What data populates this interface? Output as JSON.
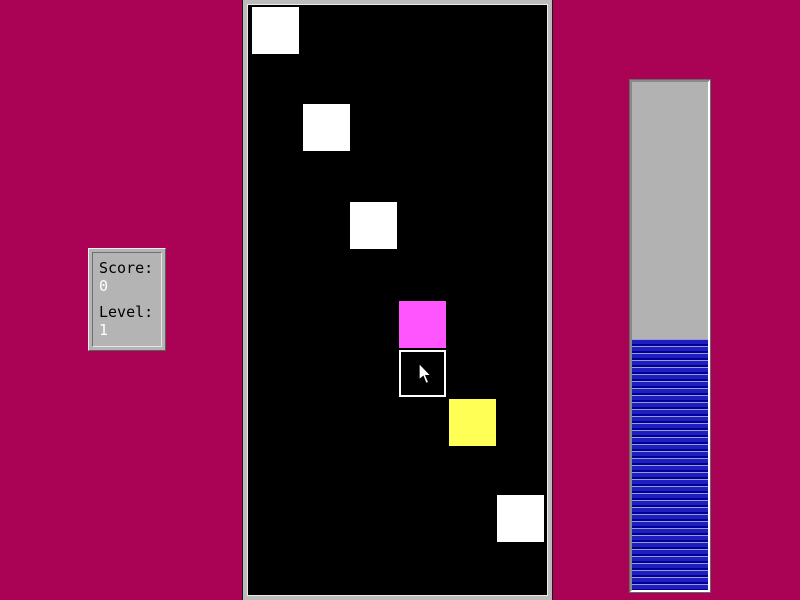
{
  "window": {
    "background_color": "#aa0355"
  },
  "score_panel": {
    "score_label": "Score:",
    "score_value": "0",
    "level_label": "Level:",
    "level_value": "1",
    "panel_color": "#b4b4b4"
  },
  "playfield": {
    "background_color": "#000000",
    "tile_size": 47,
    "tiles": [
      {
        "kind": "solid",
        "color": "#ffffff",
        "x": 4,
        "y": 2
      },
      {
        "kind": "solid",
        "color": "#ffffff",
        "x": 55,
        "y": 99
      },
      {
        "kind": "solid",
        "color": "#ffffff",
        "x": 102,
        "y": 197
      },
      {
        "kind": "solid",
        "color": "#ff55ff",
        "x": 151,
        "y": 296
      },
      {
        "kind": "outline",
        "color": "#ffffff",
        "x": 151,
        "y": 345
      },
      {
        "kind": "solid",
        "color": "#ffff55",
        "x": 201,
        "y": 394
      },
      {
        "kind": "solid",
        "color": "#ffffff",
        "x": 249,
        "y": 490
      }
    ]
  },
  "progress_bar": {
    "fill_percent": 49.5,
    "track_color": "#b2b2b2",
    "stripe_light": "#9a9ad6",
    "stripe_main": "#1f1fc0",
    "stripe_dark": "#000096"
  }
}
